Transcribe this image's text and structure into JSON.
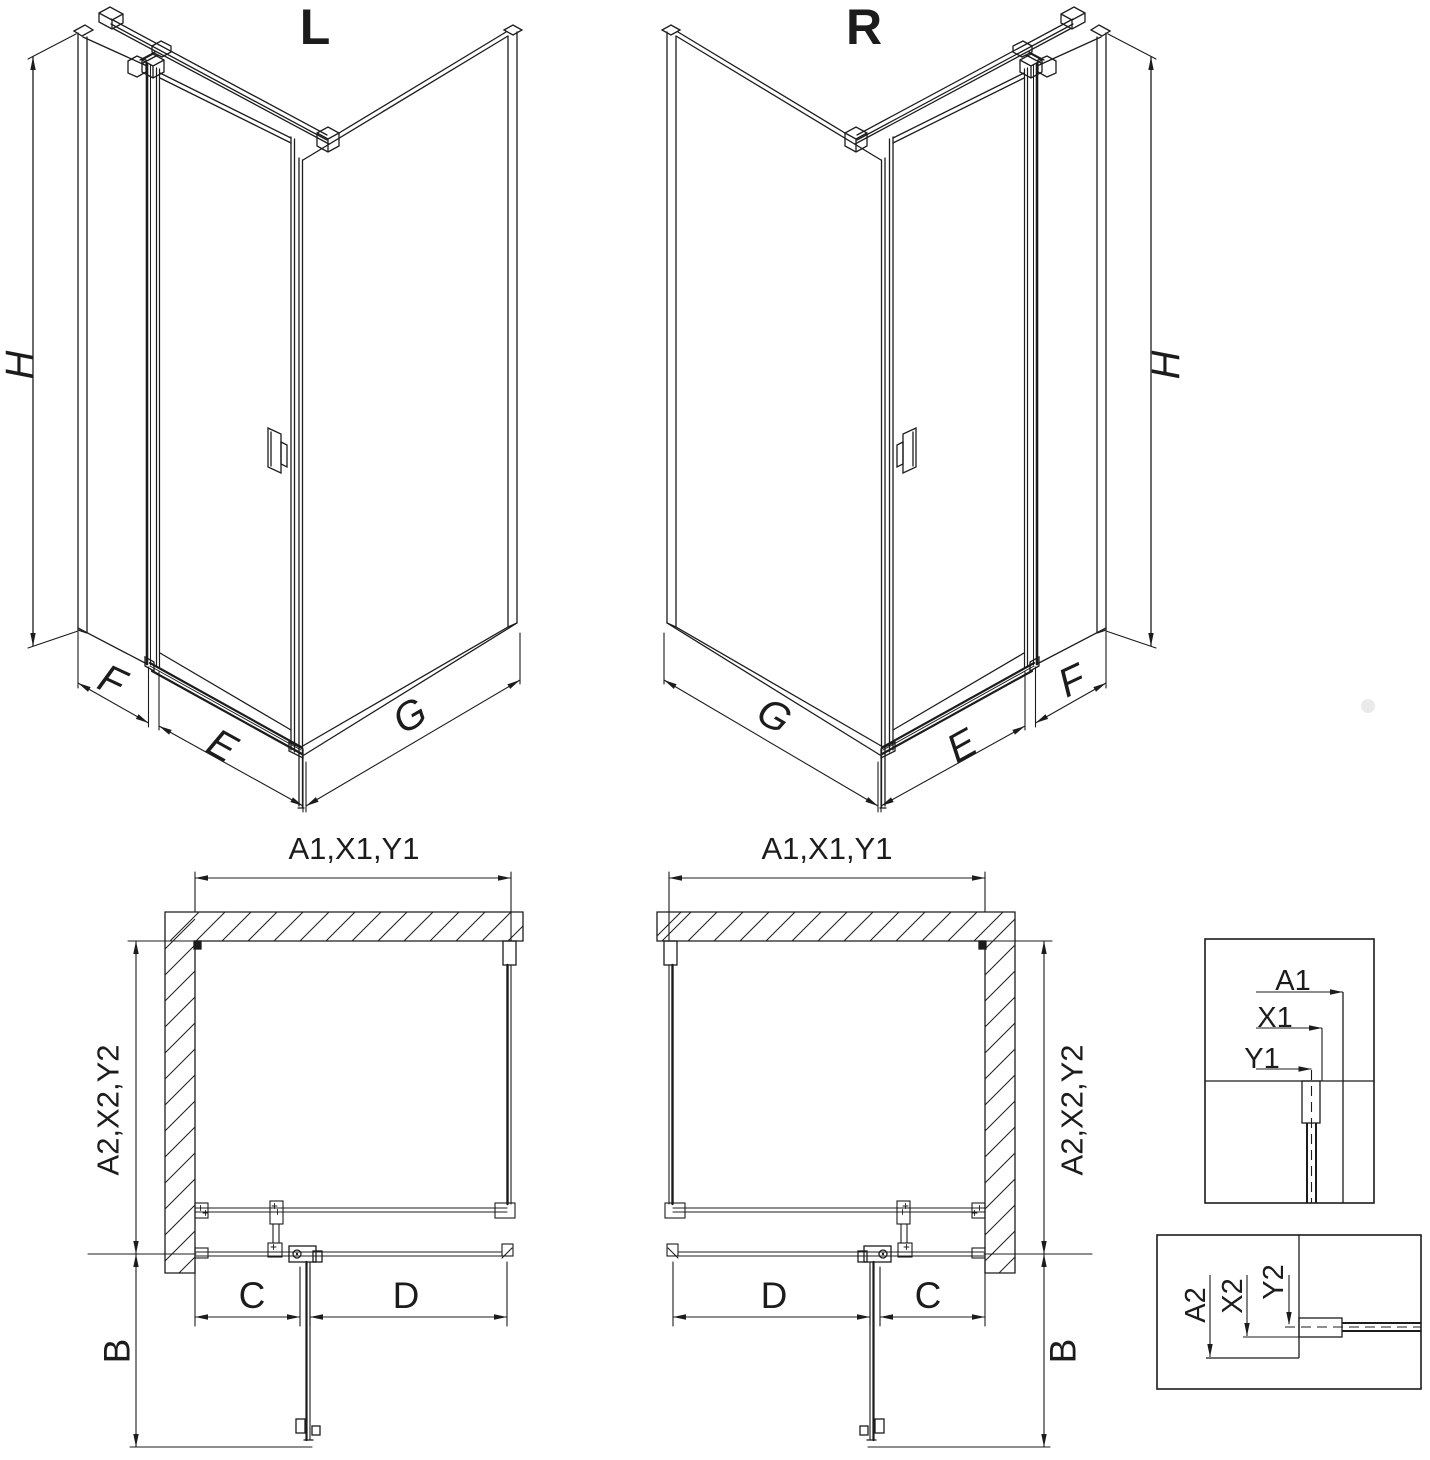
{
  "diagram": {
    "type": "technical-drawing",
    "subject": "corner shower enclosure with pivot door, left and right variants",
    "colors": {
      "line": "#1c1c1c",
      "background": "#ffffff",
      "watermark_dot": "#e6e6e6"
    },
    "views": {
      "iso_left": {
        "variant": "L",
        "height_dim": "H",
        "side_panel_dim": "F",
        "door_dim": "E",
        "return_panel_dim": "G"
      },
      "iso_right": {
        "variant": "R",
        "height_dim": "H",
        "side_panel_dim": "F",
        "door_dim": "E",
        "return_panel_dim": "G"
      },
      "plan_left": {
        "width_dim": "A1,X1,Y1",
        "depth_dim": "A2,X2,Y2",
        "swing_dim": "B",
        "fixed_dim": "C",
        "door_dim": "D"
      },
      "plan_right": {
        "width_dim": "A1,X1,Y1",
        "depth_dim": "A2,X2,Y2",
        "swing_dim": "B",
        "fixed_dim": "C",
        "door_dim": "D"
      },
      "detail_width": {
        "labels": [
          "A1",
          "X1",
          "Y1"
        ]
      },
      "detail_depth": {
        "labels": [
          "A2",
          "X2",
          "Y2"
        ]
      }
    }
  }
}
